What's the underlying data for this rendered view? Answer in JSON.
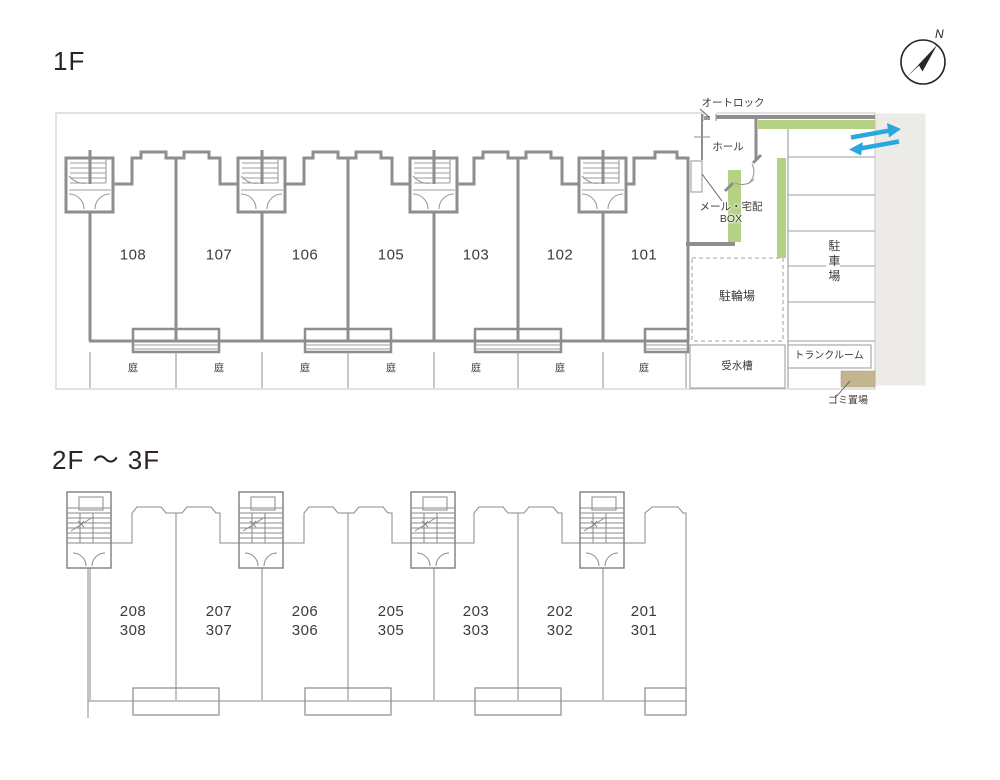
{
  "titles": {
    "floor1": "1F",
    "floor23": "2F ～ 3F"
  },
  "compass": {
    "north": "N"
  },
  "floor1": {
    "units": [
      "108",
      "107",
      "106",
      "105",
      "103",
      "102",
      "101"
    ],
    "garden_labels": [
      "庭",
      "庭",
      "庭",
      "庭",
      "庭",
      "庭",
      "庭"
    ],
    "annotations": {
      "autolock": "オートロック",
      "hall": "ホール",
      "mailbox_line1": "メール・宅配",
      "mailbox_line2": "BOX",
      "bicycle_parking": "駐輪場",
      "car_parking": "駐車場",
      "water_tank": "受水槽",
      "trunk_room": "トランクルーム",
      "garbage_area": "ゴミ置場"
    }
  },
  "floor23": {
    "units": [
      {
        "f2": "208",
        "f3": "308"
      },
      {
        "f2": "207",
        "f3": "307"
      },
      {
        "f2": "206",
        "f3": "306"
      },
      {
        "f2": "205",
        "f3": "305"
      },
      {
        "f2": "203",
        "f3": "303"
      },
      {
        "f2": "202",
        "f3": "302"
      },
      {
        "f2": "201",
        "f3": "301"
      }
    ]
  },
  "colors": {
    "wall": "#8e8e8e",
    "thin_line": "#9c9c9c",
    "greenery": "#b5d284",
    "road": "#edebe7",
    "garbage": "#c4b590",
    "arrow_blue": "#29a8e0",
    "text": "#3f3a37"
  }
}
